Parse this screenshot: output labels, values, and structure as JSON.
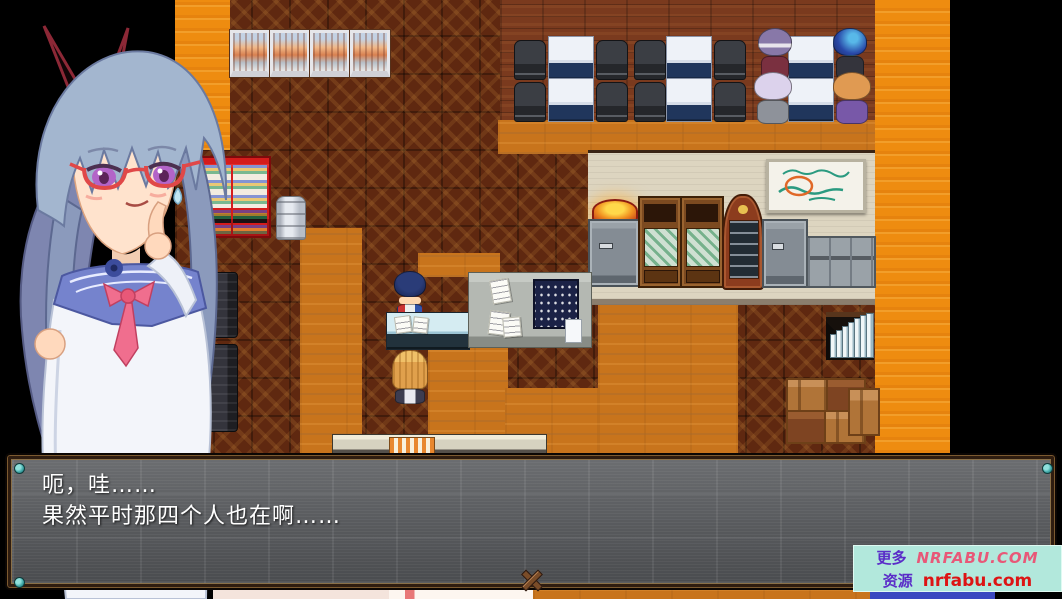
{
  "dialogue": {
    "line1": "呃，哇……",
    "line2": "果然平时那四个人也在啊……"
  },
  "watermark": {
    "more_label": "更多",
    "more_site": "NRFABU.COM",
    "res_label": "资源",
    "res_site": "nrfabu.com"
  },
  "colors": {
    "floor_orange": "#c8741c",
    "crate_brown": "#5f2810",
    "accent_wall_orange": "#ee8c10",
    "office_wall_beige": "#ddd5c0",
    "vending_red": "#d41c1c",
    "dialog_bg_grey": "#5a5c5f",
    "dialog_frame_brown": "#2f1d10",
    "corner_screw_teal": "#3fa8a8",
    "watermark_bg_cyan": "#b2e8dc",
    "watermark_purple": "#5a2cc8",
    "watermark_pink": "#e85878",
    "watermark_red": "#dd1414"
  }
}
